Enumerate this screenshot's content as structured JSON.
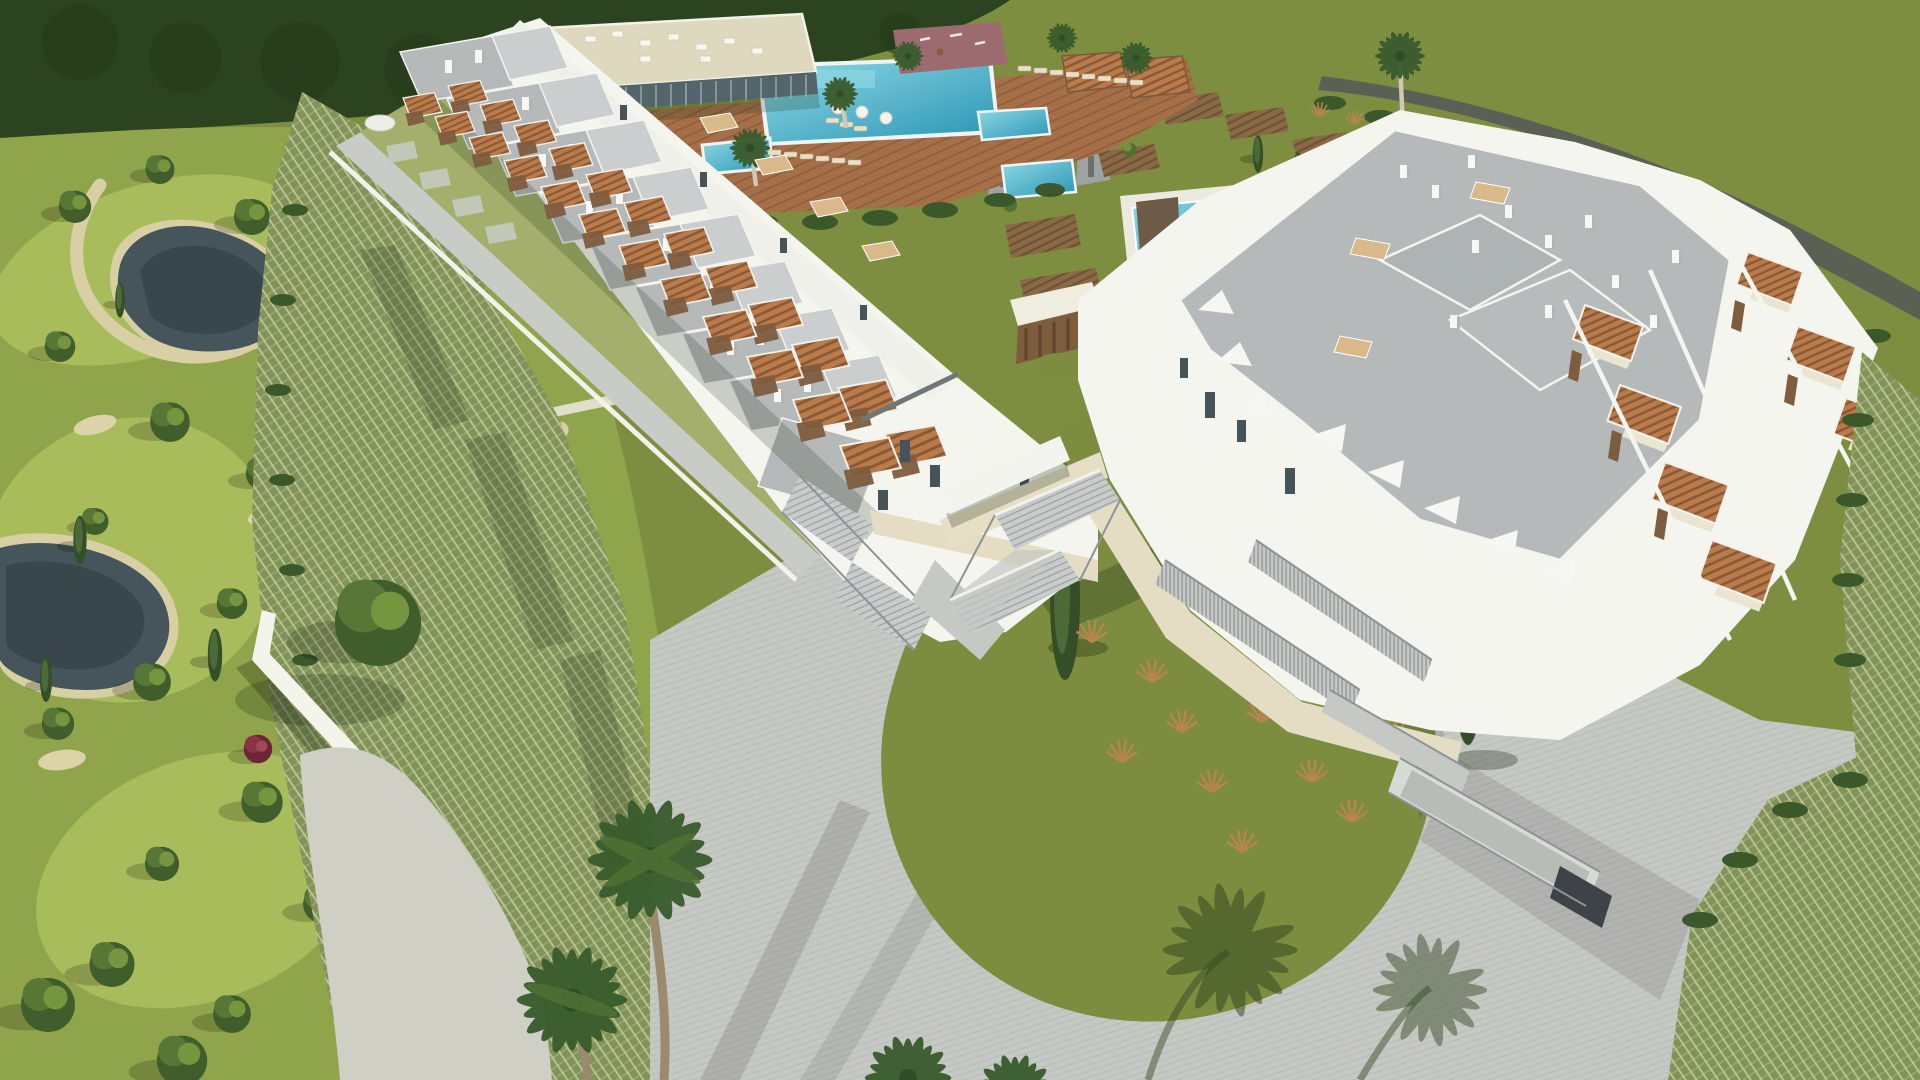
{
  "image": {
    "kind": "3d-architectural-aerial-render",
    "description": "Bird's-eye daytime rendering of a white modern resort residential development: a long row of stepped townhouses with terracotta pergola terraces, a large apartment block with grey flat roofs, a clubhouse with turquoise swimming pools and timber sun deck, a landscaped golf-course park with ponds on the left, a central circular lawn island ringed by a paved driveway, palm trees and cypresses throughout.",
    "width_px": 1920,
    "height_px": 1080
  },
  "palette": {
    "field": "#7E8E41",
    "forest": "#2C431F",
    "road": "#5A6154",
    "hedge": "#3A5829",
    "golf": "#90A54B",
    "golf_light": "#A9BC5B",
    "sand": "#D8CFA4",
    "gravel": "#D0CFC5",
    "pond": "#46555B",
    "pond_dark": "#39474D",
    "pool_light": "#8FD9E4",
    "pool_deep": "#2A95B5",
    "deck_wood": "#A57048",
    "deck_line": "#8F5D3C",
    "pergola": "#B97B4A",
    "pergola_gap": "#8A5835",
    "wood_screen": "#7E5C3E",
    "building_white": "#F5F5F0",
    "beige_plinth": "#E4DDC3",
    "roof_grey": "#B5B9BA",
    "roof_light": "#CBCECF",
    "glass": "#53646A",
    "window": "#46545A",
    "paving": "#C6C8C4",
    "paving_line": "#B9BBB7",
    "railing": "#70777B",
    "grasscrete": "#82935A",
    "grasscrete_mark": "#C9D1A0",
    "lawn": "#7D8D40",
    "ornamental_grass": "#B5854E",
    "playground": "#9C6B70",
    "plot_soil": "#8A6A46",
    "plot_line": "#6E5234",
    "palm_frond": "#3A5C2D",
    "trunk": "#9B8A6D"
  },
  "scene": {
    "areas": [
      "forest-treeline",
      "meadow-field",
      "access-road",
      "golf-course",
      "ponds",
      "clubhouse",
      "main-pool",
      "kids-pool",
      "lap-pool",
      "timber-sun-deck",
      "playground",
      "garden-plots",
      "utility-sheds",
      "left-townhouse-row",
      "pergola-terraces",
      "right-apartment-block",
      "central-courtyard",
      "entrance-pavilions",
      "central-lawn",
      "circular-driveway",
      "grasscrete-parking",
      "stairs-and-ramps",
      "palm-trees",
      "perimeter-wall"
    ]
  }
}
